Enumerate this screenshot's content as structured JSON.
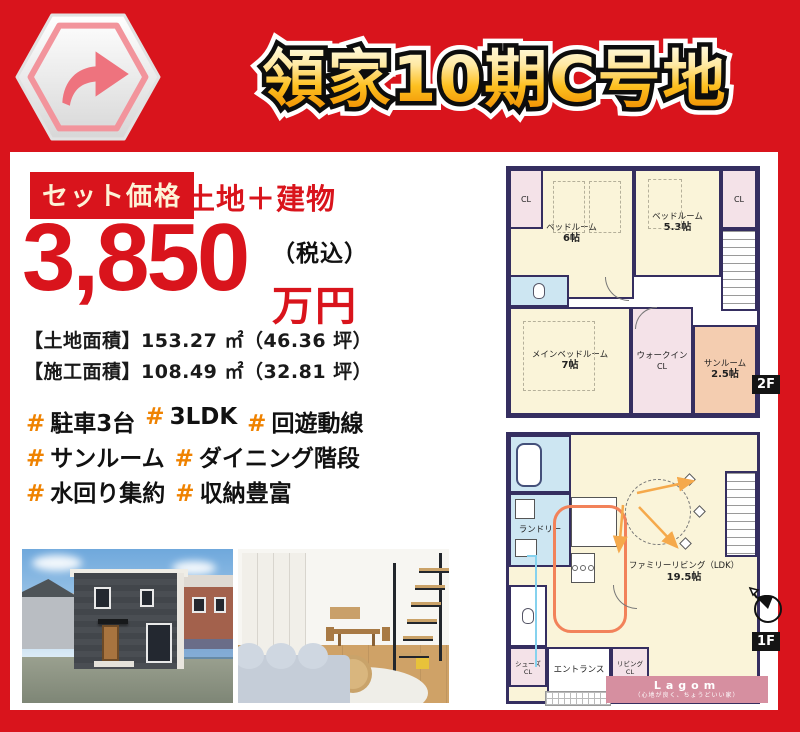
{
  "colors": {
    "brand_red": "#d9141c",
    "title_gold": "#f5a300",
    "hash_orange": "#ef8200",
    "wall_navy": "#352e60",
    "lagom_pink": "#d68fa0"
  },
  "header": {
    "title": "領家10期C号地"
  },
  "price": {
    "badge": "セット価格",
    "subtitle": "土地＋建物",
    "amount": "3,850",
    "tax_note": "（税込）",
    "unit": "万円",
    "land_area_label": "【土地面積】",
    "land_area_value": "153.27 ㎡（46.36 坪）",
    "build_area_label": "【施工面積】",
    "build_area_value": "108.49 ㎡（32.81 坪）"
  },
  "hashtags": {
    "symbol": "#",
    "line1": [
      {
        "label": "駐車3台"
      },
      {
        "label": "3LDK"
      },
      {
        "label": "回遊動線"
      }
    ],
    "line2": [
      {
        "label": "サンルーム"
      },
      {
        "label": "ダイニング階段"
      }
    ],
    "line3": [
      {
        "label": "水回り集約"
      },
      {
        "label": "収納豊富"
      }
    ]
  },
  "plan2f": {
    "floor": "2F",
    "bedroom1_name": "ベッドルーム",
    "bedroom1_size": "6帖",
    "bedroom2_name": "ベッドルーム",
    "bedroom2_size": "5.3帖",
    "main_bedroom_name": "メインベッドルーム",
    "main_bedroom_size": "7帖",
    "walkin_name": "ウォークイン",
    "walkin_cl": "CL",
    "sunroom_name": "サンルーム",
    "sunroom_size": "2.5帖",
    "cl_left": "CL",
    "cl_right": "CL"
  },
  "plan1f": {
    "floor": "1F",
    "laundry": "ランドリー",
    "ldk_name": "ファミリーリビング（LDK）",
    "ldk_size": "19.5帖",
    "shoes_name": "シューズ",
    "shoes_cl": "CL",
    "entrance": "エントランス",
    "livingcl_name": "リビング",
    "livingcl_cl": "CL"
  },
  "logo": {
    "name": "Lagom",
    "tagline": "（心地が良く、ちょうどいい家）"
  }
}
